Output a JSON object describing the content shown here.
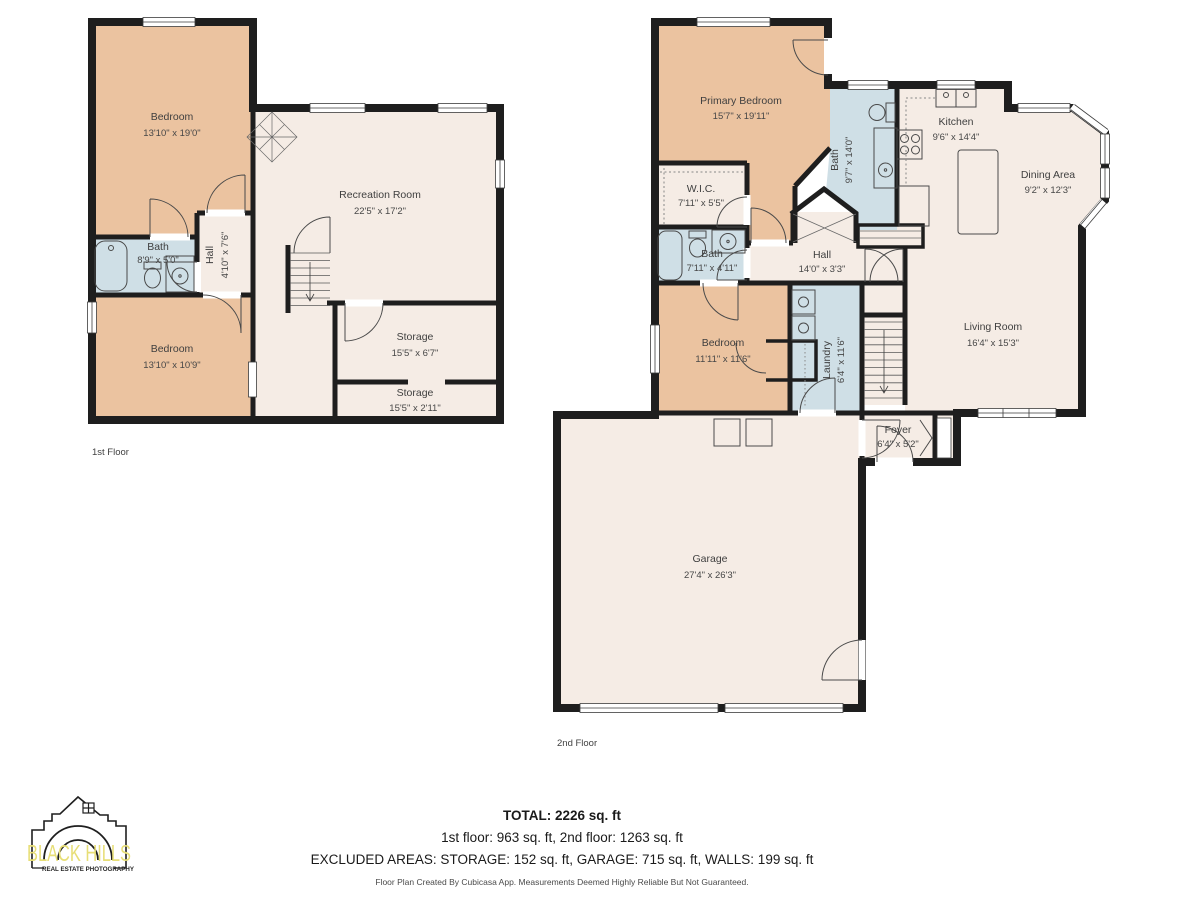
{
  "floors": [
    {
      "label": "1st Floor",
      "rooms": [
        {
          "name": "Bedroom",
          "dims": "13'10\" x 19'0\""
        },
        {
          "name": "Recreation Room",
          "dims": "22'5\" x 17'2\""
        },
        {
          "name": "Bath",
          "dims": "8'9\" x 5'0\""
        },
        {
          "name": "Hall",
          "dims": "4'10\" x 7'6\""
        },
        {
          "name": "Bedroom",
          "dims": "13'10\" x 10'9\""
        },
        {
          "name": "Storage",
          "dims": "15'5\" x 6'7\""
        },
        {
          "name": "Storage",
          "dims": "15'5\" x 2'11\""
        }
      ]
    },
    {
      "label": "2nd Floor",
      "rooms": [
        {
          "name": "Primary Bedroom",
          "dims": "15'7\" x 19'11\""
        },
        {
          "name": "W.I.C.",
          "dims": "7'11\" x 5'5\""
        },
        {
          "name": "Bath",
          "dims": "9'7\" x 14'0\""
        },
        {
          "name": "Kitchen",
          "dims": "9'6\" x 14'4\""
        },
        {
          "name": "Dining Area",
          "dims": "9'2\" x 12'3\""
        },
        {
          "name": "Bath",
          "dims": "7'11\" x 4'11\""
        },
        {
          "name": "Hall",
          "dims": "14'0\" x 3'3\""
        },
        {
          "name": "Bedroom",
          "dims": "11'11\" x 11'6\""
        },
        {
          "name": "Laundry",
          "dims": "6'4\" x 11'6\""
        },
        {
          "name": "Living Room",
          "dims": "16'4\" x 15'3\""
        },
        {
          "name": "Foyer",
          "dims": "6'4\" x 5'2\""
        },
        {
          "name": "Garage",
          "dims": "27'4\" x 26'3\""
        }
      ]
    }
  ],
  "summary": {
    "total": "TOTAL: 2226 sq. ft",
    "floors_line": "1st floor: 963 sq. ft, 2nd floor: 1263 sq. ft",
    "excluded_line": "EXCLUDED AREAS: STORAGE: 152 sq. ft, GARAGE: 715 sq. ft, WALLS: 199 sq. ft",
    "disclaimer": "Floor Plan Created By Cubicasa App. Measurements Deemed Highly Reliable But Not Guaranteed."
  },
  "logo": {
    "brand": "BLACK HILLS",
    "tagline": "REAL ESTATE PHOTOGRAPHY",
    "accent_color": "#e7de76"
  },
  "colors": {
    "wall": "#1e1e1e",
    "bedroom_fill": "#ebc3a0",
    "wet_room_fill": "#cfdfe6",
    "room_fill": "#f5ece5",
    "label_text": "#3f3f3f"
  }
}
